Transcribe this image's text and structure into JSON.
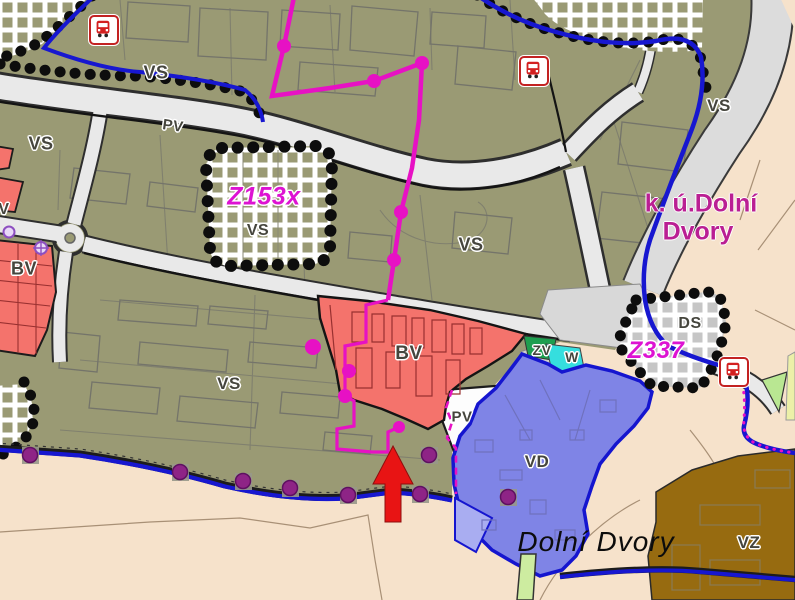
{
  "map": {
    "place_names": {
      "municipality": "Dolní Dvory",
      "cadastral_area_line1": "k. ú.Dolní",
      "cadastral_area_line2": "Dvory"
    },
    "zone_change_codes": {
      "z153x": "Z153x",
      "z337": "Z337"
    },
    "area_labels": {
      "vs_top_left": "VS",
      "vs_left": "VS",
      "vs_in_z153x": "VS",
      "vs_center": "VS",
      "vs_top_right": "VS",
      "vs_lower_left": "VS",
      "bv_left": "BV",
      "bv_center": "BV",
      "vd": "VD",
      "vz": "VZ",
      "ds": "DS",
      "zv": "ZV",
      "w": "W",
      "v_edge": "V",
      "pv_road": "PV",
      "pv_small": "PV"
    },
    "icons": {
      "bus_stop": "bus-stop",
      "highlight_arrow": "red-up-arrow"
    },
    "colors": {
      "area_vs_olive": "#9a9a74",
      "area_bv_red": "#f4736c",
      "area_vd_blue": "#7f84e6",
      "area_vz_brown": "#976b10",
      "background_beige": "#f6e2cb",
      "road_fill": "#e9e9e9",
      "boundary_blue": "#1717d0",
      "development_magenta": "#e711c4",
      "hatch_dots_black": "#0d0d0d",
      "water_w_cyan": "#35dede",
      "green_zv": "#1e9e4f",
      "arrow_red": "#e81414"
    }
  }
}
